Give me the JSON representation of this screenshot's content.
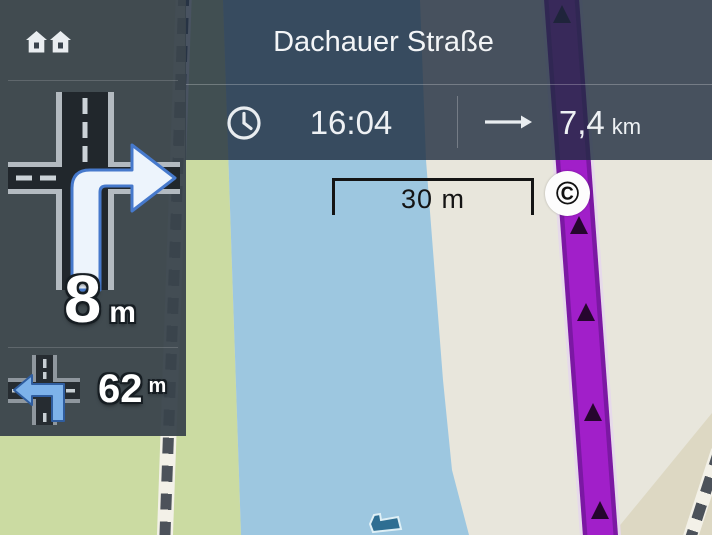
{
  "topbar": {
    "street_name": "Dachauer Straße",
    "arrival": {
      "time": "16:04"
    },
    "remaining": {
      "value": "7,4",
      "unit": "km"
    }
  },
  "maneuvers": {
    "primary": {
      "distance_value": "8",
      "distance_unit": "m",
      "type": "turn-right"
    },
    "secondary": {
      "distance_value": "62",
      "distance_unit": "m",
      "type": "turn-left"
    }
  },
  "map": {
    "scale_label": "30 m",
    "copyright_symbol": "©",
    "colors": {
      "water": "#9dc7e0",
      "land_green": "#cbdba2",
      "land_beige": "#e8e6dc",
      "land_tan": "#ddd8c3",
      "route": "#a11fc9",
      "route_edge": "#7b18a3",
      "sidebar": "rgba(57,67,76,0.95)",
      "bar_overlay": "rgba(30,44,63,0.80)",
      "maneuver_arrow_fill": "#edf4fc",
      "maneuver_arrow_stroke": "#4679cc"
    }
  },
  "icons": {
    "home": "home-icon",
    "clock": "clock-icon",
    "straight_arrow": "straight-arrow-icon",
    "primary_maneuver": "turn-right-arrow-icon",
    "secondary_maneuver": "turn-left-arrow-icon",
    "copyright": "copyright-badge"
  }
}
